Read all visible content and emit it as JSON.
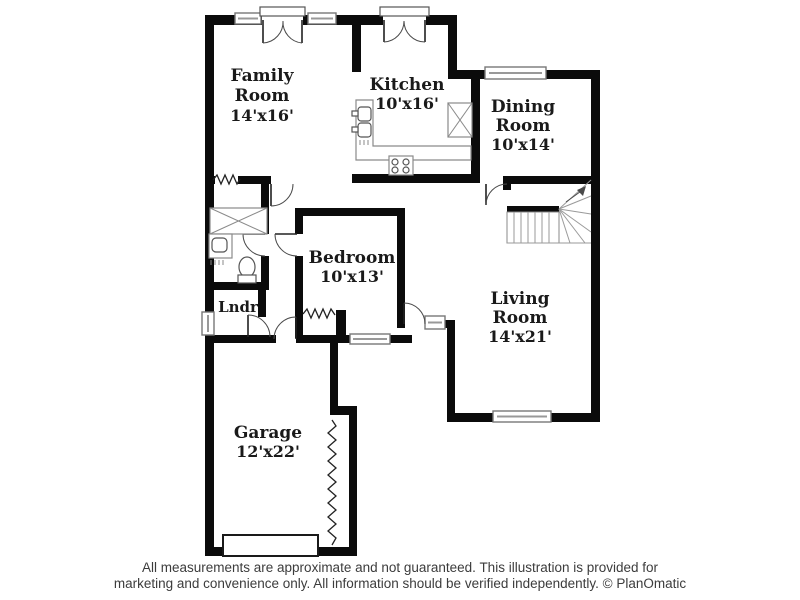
{
  "title": "Floor plan",
  "colors": {
    "wall": "#0b0b0b",
    "fixture_outline": "#8a8a8a",
    "label_text": "#1a1a1a",
    "footer_text": "#3c3c3c",
    "background": "#ffffff"
  },
  "floor_plan": {
    "rooms": {
      "family_room": {
        "line1": "Family",
        "line2": "Room",
        "dims": "14'x16'"
      },
      "kitchen": {
        "line1": "Kitchen",
        "dims": "10'x16'"
      },
      "dining_room": {
        "line1": "Dining",
        "line2": "Room",
        "dims": "10'x14'"
      },
      "bedroom": {
        "line1": "Bedroom",
        "dims": "10'x13'"
      },
      "living_room": {
        "line1": "Living",
        "line2": "Room",
        "dims": "14'x21'"
      },
      "laundry": {
        "line1": "Lndr"
      },
      "garage": {
        "line1": "Garage",
        "dims": "12'x22'"
      }
    }
  },
  "footer": {
    "line1": "All measurements are approximate and not guaranteed. This illustration is provided for",
    "line2": "marketing and convenience only. All information should be verified independently. © PlanOmatic"
  }
}
